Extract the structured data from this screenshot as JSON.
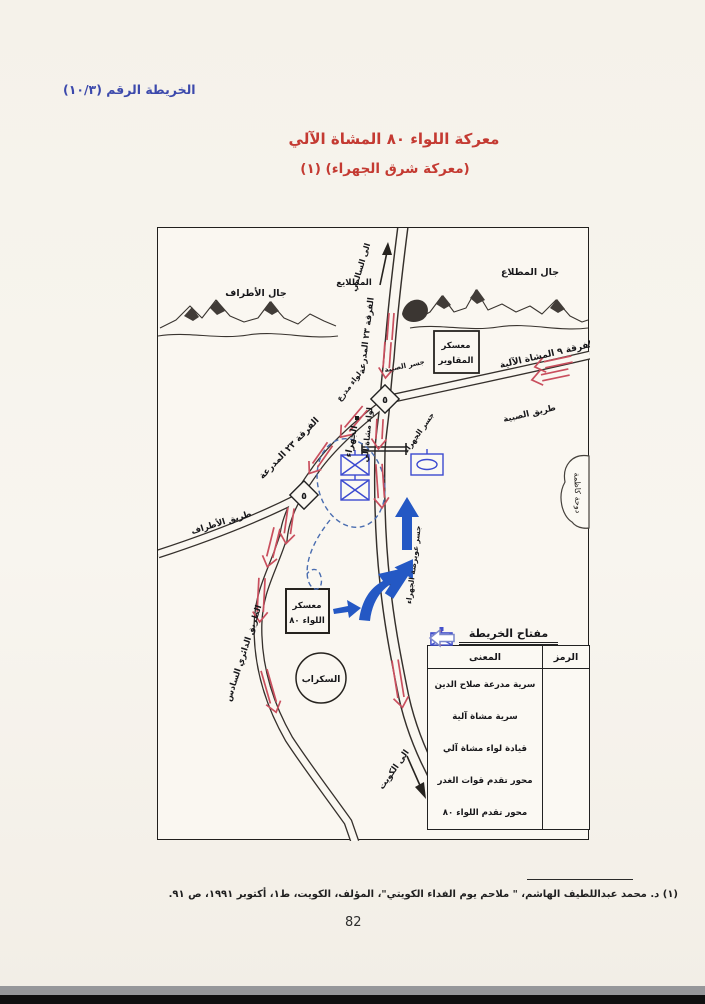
{
  "page": {
    "map_ref": "الخريطة الرقم (١٠/٣)",
    "title": "معركة اللواء ٨٠ المشاة الآلي",
    "subtitle": "(معركة شرق الجهراء) (١)",
    "footnote": "(١) د. محمد عبداللطيف الهاشم، \" ملاحم يوم الفداء الكويتي\"، المؤلف، الكويت، ط١، أكتوبر ١٩٩١، ص ٩١.",
    "page_number": "82"
  },
  "map": {
    "labels": {
      "jal_atraf": "جال الأطراف",
      "mutlaia": "المطلايع",
      "jal_mutlaa": "جال المطلاع",
      "to_salmi": "الى السالمي",
      "div23_top": "الفرقة ٢٣ المدرعة",
      "div23_branch": "الفرقة ٢٣ المدرعة",
      "div9": "الفرقة ٩ المشاة الآلية",
      "subiya_road": "طريق الصبية",
      "subiya_bridge": "جسر الصبية",
      "maqawir_camp_1": "معسكر",
      "maqawir_camp_2": "المقاوير",
      "armored_brigade": "لواء مدرع",
      "mech_brigade": "لواء مشاة آلي",
      "jahra": "الجهراء",
      "jahra_bridge": "جسر الجهراء",
      "jahra_bridge_south": "جسر عويرضة الجهراء",
      "camp80_1": "معسكر",
      "camp80_2": "اللواء ٨٠",
      "scrap": "السكراب",
      "ring_road6": "الطريق الدائري السادس",
      "atraf_road": "طريق الأطراف",
      "to_kuwait": "الى الكويت",
      "kadhma_bay": "دوحة كاظمة",
      "junction_marker": "٥"
    },
    "legend": {
      "title": "مفتاح الخريطة",
      "col_symbol": "الرمز",
      "col_meaning": "المعنى",
      "rows": [
        {
          "symbol": "armored-company-symbol",
          "meaning": "سرية مدرعة صلاح الدين"
        },
        {
          "symbol": "mech-infantry-company-symbol",
          "meaning": "سرية مشاة آلية"
        },
        {
          "symbol": "mech-brigade-hq-symbol",
          "meaning": "قيادة لواء مشاة آلي"
        },
        {
          "symbol": "enemy-advance-axis-arrow",
          "meaning": "محور تقدم قوات الغدر"
        },
        {
          "symbol": "brigade80-advance-axis-arrow",
          "meaning": "محور تقدم اللواء ٨٠"
        }
      ]
    },
    "colors": {
      "heading_blue": "#3c49ac",
      "title_red": "#c43a32",
      "enemy_axis_red": "#c94f5e",
      "brigade80_blue": "#2458c4",
      "unit_symbol_blue": "#3c4ad0"
    }
  }
}
